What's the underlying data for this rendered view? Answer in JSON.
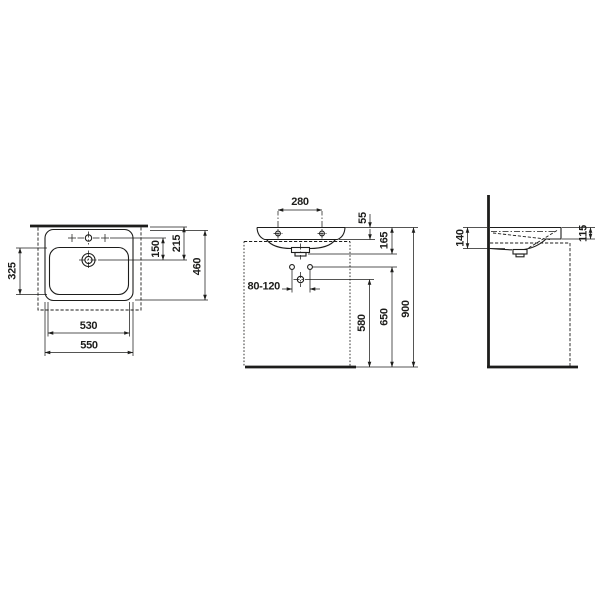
{
  "drawing": {
    "type": "washbasin-dimension-drawing",
    "units_shown": "",
    "colors": {
      "line": "#1d1d1b",
      "background": "#ffffff"
    },
    "top_view": {
      "dims": {
        "overall_width": "550",
        "bowl_width": "530",
        "bowl_depth": "325",
        "overall_depth": "460",
        "taphole_to_drain": "150",
        "rear_to_drain": "215"
      }
    },
    "front_view": {
      "dims": {
        "fixing_hole_spacing": "280",
        "rim_height": "55",
        "rim_to_outlet": "165",
        "supply_spacing_range": "80-120",
        "floor_to_drain": "580",
        "floor_to_supplies": "650",
        "floor_to_rim": "900"
      }
    },
    "side_view": {
      "dims": {
        "height_at_wall": "140",
        "height_at_front": "115"
      }
    }
  }
}
